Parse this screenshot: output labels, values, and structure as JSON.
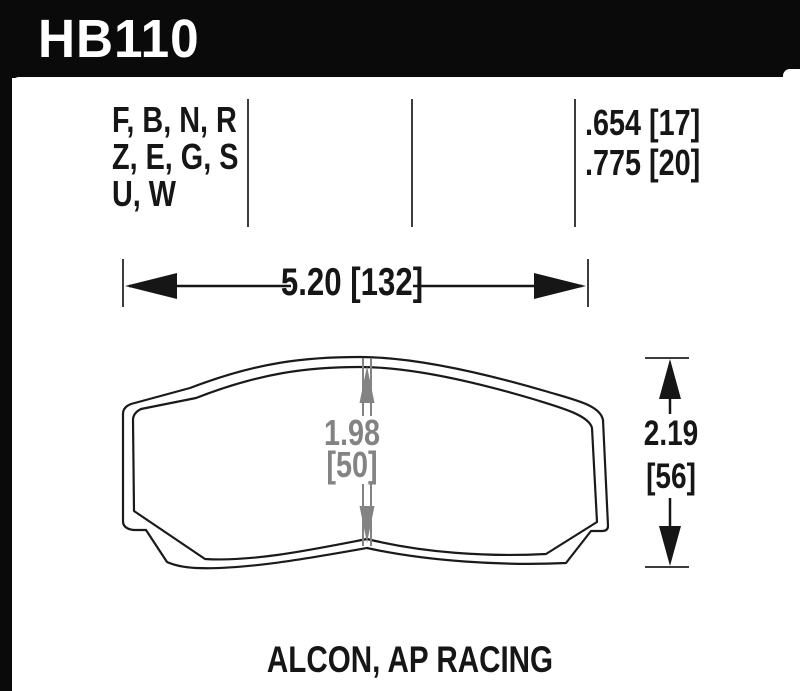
{
  "header": {
    "part_number": "HB110"
  },
  "spec_table": {
    "compound_lines": [
      "F, B, N, R",
      "Z, E, G, S",
      "U, W"
    ],
    "thickness_lines": [
      ".654 [17]",
      ".775 [20]"
    ]
  },
  "dimensions": {
    "width_label": "5.20 [132]",
    "center_value": "1.98",
    "center_bracket": "[50]",
    "height_value": "2.19",
    "height_bracket": "[56]"
  },
  "footer": {
    "applications": "ALCON, AP RACING"
  },
  "colors": {
    "frame_black": "#0a0a0a",
    "ink": "#161616",
    "divider_gray": "#3c3c3c",
    "dimension_gray": "#838383",
    "paper_white": "#ffffff"
  }
}
